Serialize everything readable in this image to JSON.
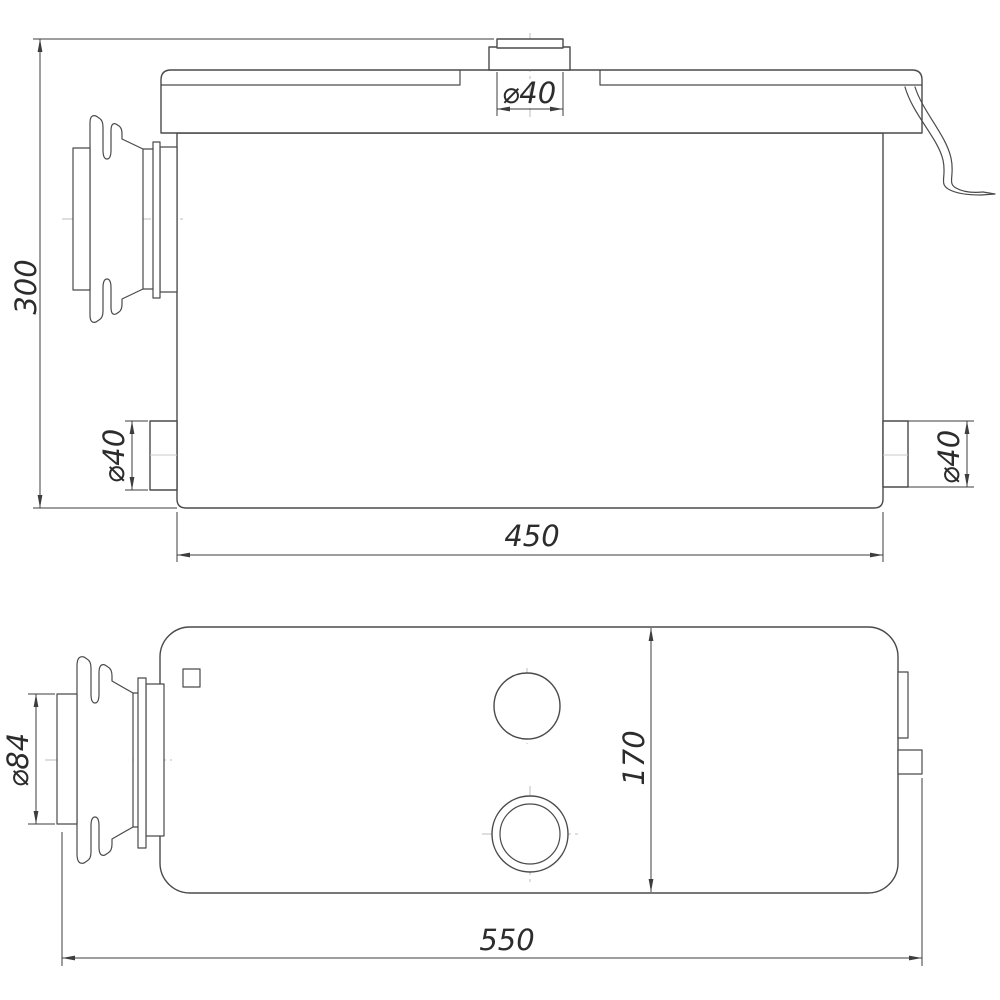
{
  "drawing": {
    "type": "technical-dimension-drawing",
    "views": {
      "front": {
        "dimensions": {
          "overall_height": "300",
          "top_outlet_diameter": "⌀40",
          "left_outlet_diameter": "⌀40",
          "right_outlet_diameter": "⌀40",
          "body_length": "450"
        }
      },
      "plan": {
        "dimensions": {
          "inlet_diameter": "⌀84",
          "body_width": "170",
          "overall_length": "550"
        }
      }
    },
    "colors": {
      "line": "#4a4a4a",
      "dim": "#3d3d3d",
      "centerline": "#bcbcbc",
      "background": "#ffffff"
    }
  }
}
